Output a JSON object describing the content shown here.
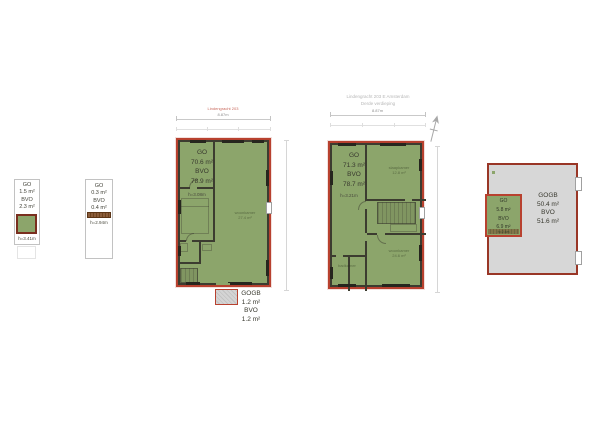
{
  "colors": {
    "plan_fill_green": "#8ca56b",
    "plan_border_red": "#b8412f",
    "wall_dark": "#3c3c30",
    "terrace_gray": "#d7d7d7",
    "stair_brown": "#8a5c3a",
    "dim_gray": "#c9c9c9"
  },
  "header": {
    "line1": "Lindengracht 203 E Amsterdam",
    "line2": "Derde verdieping"
  },
  "annotations": {
    "street_label_red": "Lindengracht 203",
    "plan3_width_dim": "8.87m",
    "plan4_width_dim": "8.87m",
    "compass": "north-arrow"
  },
  "plan1": {
    "go_label": "GO",
    "go_value": "1.5 m²",
    "bvo_label": "BVO",
    "bvo_value": "2.3 m²",
    "height_label": "h=3.41m"
  },
  "plan2": {
    "go_label": "GO",
    "go_value": "0.3 m²",
    "bvo_label": "BVO",
    "bvo_value": "0.4 m²",
    "height_label": "h=2.94m"
  },
  "plan3": {
    "go_label": "GO",
    "go_value": "70.6 m²",
    "bvo_label": "BVO",
    "bvo_value": "78.9 m²",
    "height_label": "h=3.08m",
    "room_label": "woonkamer",
    "room_area": "27.4 m²",
    "porch": {
      "gogb_label": "GOGB",
      "gogb_value": "1.2 m²",
      "bvo_label": "BVO",
      "bvo_value": "1.2 m²"
    }
  },
  "plan4": {
    "go_label": "GO",
    "go_value": "71.3 m²",
    "bvo_label": "BVO",
    "bvo_value": "78.7 m²",
    "height_label": "h=3.21m",
    "room_top_label": "slaapkamer",
    "room_top_area": "12.8 m²",
    "room_bottom_label": "woonkamer",
    "room_bottom_area": "24.6 m²",
    "room_left_label": "badkamer"
  },
  "plan5": {
    "inner": {
      "go_label": "GO",
      "go_value": "5.8 m²",
      "bvo_label": "BVO",
      "bvo_value": "6.9 m²",
      "height_label": "h=2.4m"
    },
    "gogb_label": "GOGB",
    "gogb_value": "50.4 m²",
    "bvo_label": "BVO",
    "bvo_value": "51.6 m²"
  }
}
